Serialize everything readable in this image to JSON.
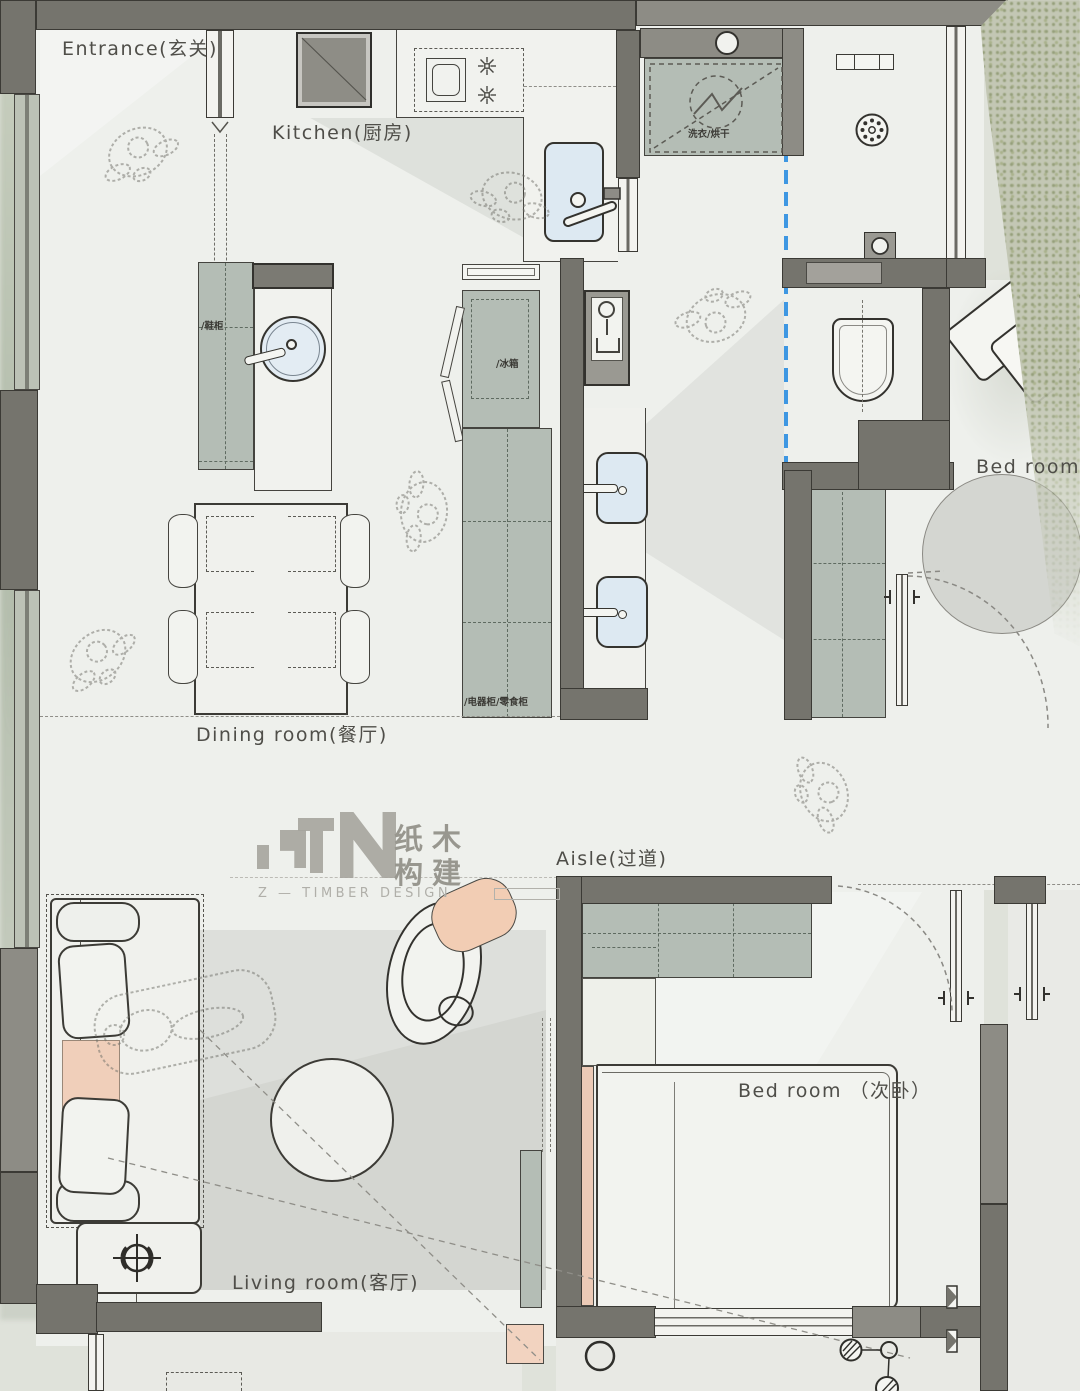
{
  "brand": {
    "logo_cn_1": "纸木",
    "logo_cn_2": "构建",
    "logo_en": "Z — TIMBER DESIGN"
  },
  "rooms": {
    "entrance": "Entrance(玄关)",
    "kitchen": "Kitchen(厨房)",
    "dining": "Dining room(餐厅)",
    "aisle": "Aisle(过道)",
    "living": "Living room(客厅)",
    "bedroom_master": "Bed room",
    "bedroom_secondary": "Bed room （次卧）"
  },
  "fixtures": {
    "laundry": "洗衣/烘干",
    "shoe_cabinet": "/鞋柜",
    "fridge": "/冰箱",
    "appliance_snack": "/电器柜/零食柜"
  },
  "colors": {
    "wall_dark": "#75746d",
    "wall_light": "#a3a19b",
    "floor": "#eef0ec",
    "cabinet_green": "#b4bdb5",
    "fixture_blue": "#dde9f2",
    "glass_blue": "#3e97e2",
    "accent_peach": "#f0cfba",
    "rug_gray": "#cfd1cd",
    "line_dark": "#3a3936",
    "label_text": "#4f4e49",
    "foliage_green": "#aab293"
  }
}
